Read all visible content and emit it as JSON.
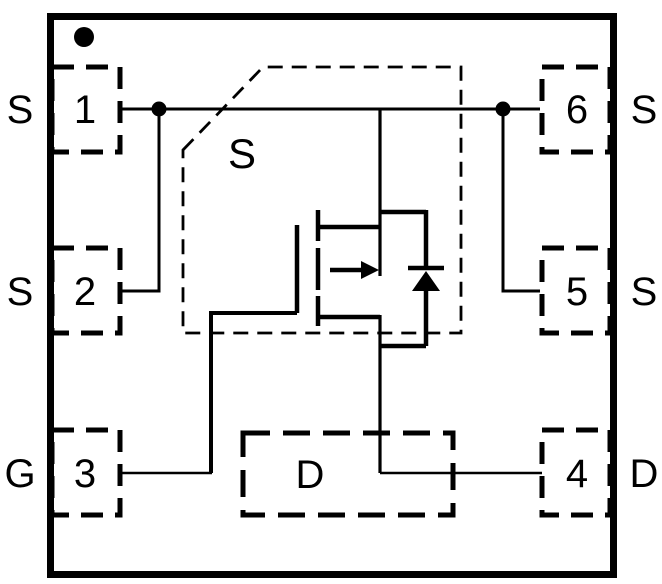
{
  "figure": {
    "title": "6-pin package pin configuration with MOSFET symbol",
    "package": {
      "pin1_indicator": "dot",
      "outline": "square"
    },
    "left_pins": [
      {
        "number": "1",
        "function": "S"
      },
      {
        "number": "2",
        "function": "S"
      },
      {
        "number": "3",
        "function": "G"
      }
    ],
    "right_pins": [
      {
        "number": "6",
        "function": "S"
      },
      {
        "number": "5",
        "function": "S"
      },
      {
        "number": "4",
        "function": "D"
      }
    ],
    "die_outline_label": "S",
    "center_pad_label": "D",
    "symbol": "p-channel-mosfet-with-body-diode",
    "colors": {
      "line": "#000000",
      "background": "#ffffff"
    }
  }
}
